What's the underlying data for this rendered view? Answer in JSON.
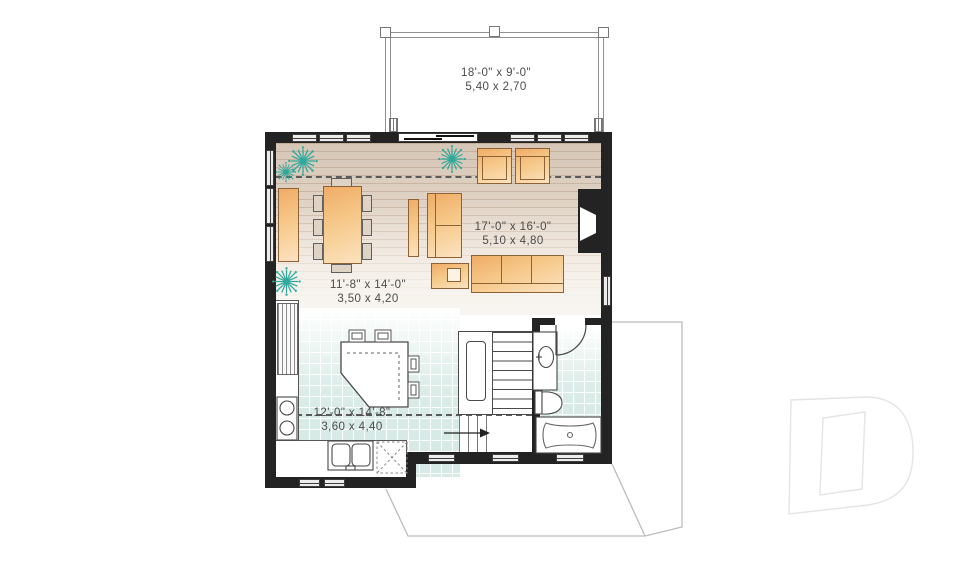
{
  "plan_title": "second-floor-plan",
  "rooms": {
    "deck": {
      "imperial": "18'-0\" x 9'-0\"",
      "metric": "5,40 x 2,70"
    },
    "living": {
      "imperial": "17'-0\" x 16'-0\"",
      "metric": "5,10 x 4,80"
    },
    "dining": {
      "imperial": "11'-8\" x 14'-0\"",
      "metric": "3,50 x 4,20"
    },
    "kitchen": {
      "imperial": "12'-0\" x 14'-8\"",
      "metric": "3,60 x 4,40"
    }
  },
  "colors": {
    "wall": "#232323",
    "furniture_orange": "#f2b678",
    "tile_teal": "#d7eae5",
    "wood_tan": "#d6c7b8",
    "plant_teal": "#2ea79c",
    "label_text": "#4c4c4c",
    "outline_gray": "#909090",
    "watermark_gray": "#e4e4e4"
  },
  "icons": [
    "plant-icon",
    "cooktop-icon",
    "kitchen-sink-icon",
    "dishwasher-icon",
    "vanity-sink-icon",
    "toilet-icon",
    "bathtub-icon",
    "fireplace-icon",
    "door-swing-icon",
    "stairs-up-arrow-icon",
    "drummond-logo-watermark"
  ]
}
